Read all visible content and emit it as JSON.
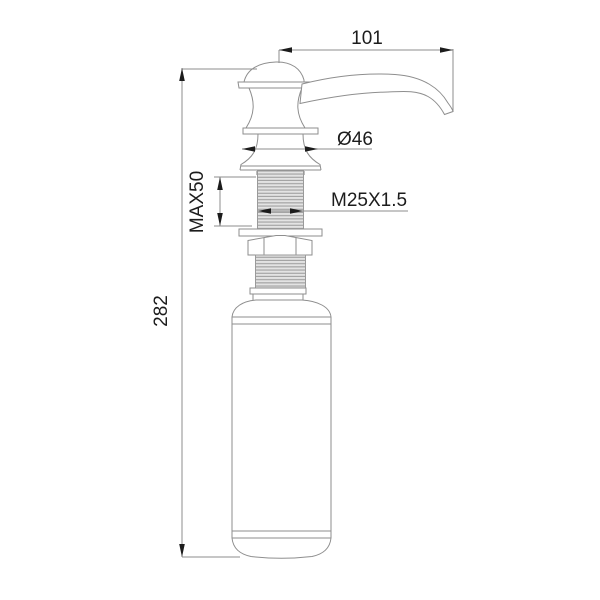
{
  "drawing": {
    "type": "technical-dimension-drawing",
    "subject": "kitchen sink soap dispenser, side elevation",
    "units": "mm",
    "colors": {
      "background": "#ffffff",
      "outline": "#8e8e8e",
      "dimension_line": "#8e8e8e",
      "dimension_text": "#1c1c1c",
      "thread_fill": "#e3e3e3",
      "thread_stripe": "#9f9f9f"
    },
    "labels": {
      "spout_reach": "101",
      "overall_height": "282",
      "head_diameter": "Ø46",
      "max_deck_thickness": "MAX50",
      "thread_spec": "M25X1.5"
    }
  }
}
